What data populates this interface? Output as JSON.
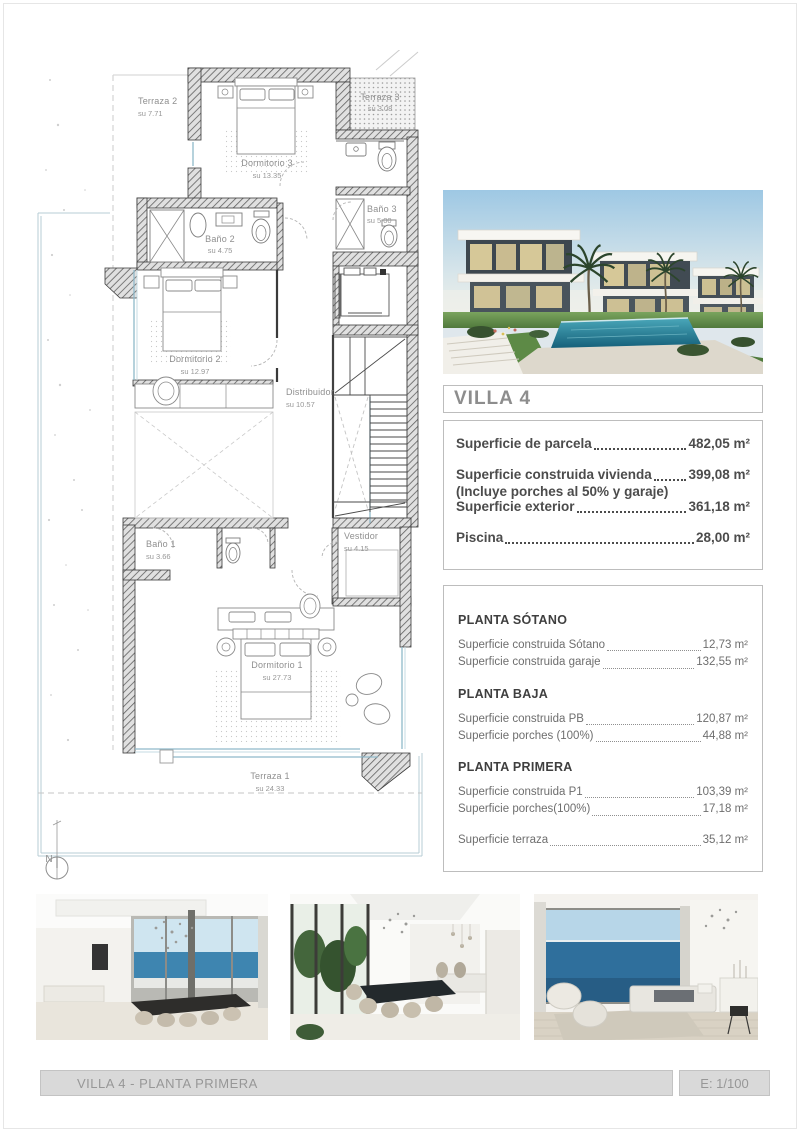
{
  "document": {
    "footer_title": "VILLA 4 - PLANTA PRIMERA",
    "footer_scale": "E: 1/100"
  },
  "info": {
    "title": "VILLA 4",
    "summary": [
      {
        "label": "Superficie de parcela",
        "value": "482,05 m²",
        "note": ""
      },
      {
        "label": "Superficie construida vivienda",
        "value": "399,08 m²",
        "note": "(Incluye porches al 50% y garaje)"
      },
      {
        "label": "Superficie exterior",
        "value": "361,18 m²",
        "note": ""
      },
      {
        "label": "Piscina",
        "value": "28,00 m²",
        "note": ""
      }
    ],
    "floors": [
      {
        "heading": "PLANTA SÓTANO",
        "rows": [
          {
            "label": "Superficie  construida Sótano",
            "value": "12,73 m²"
          },
          {
            "label": "Superficie construida garaje",
            "value": "132,55 m²"
          }
        ]
      },
      {
        "heading": "PLANTA BAJA",
        "rows": [
          {
            "label": "Superficie construida PB",
            "value": "120,87 m²"
          },
          {
            "label": "Superficie porches (100%)",
            "value": "44,88 m²"
          }
        ]
      },
      {
        "heading": "PLANTA PRIMERA",
        "rows": [
          {
            "label": "Superficie construida P1",
            "value": "103,39 m²"
          },
          {
            "label": "Superficie porches(100%)",
            "value": "17,18 m²"
          }
        ]
      }
    ],
    "extra_row": {
      "label": "Superficie terraza",
      "value": "35,12 m²"
    }
  },
  "plan": {
    "compass": "N",
    "rooms": [
      {
        "name": "Terraza 2",
        "area": "su 7.71"
      },
      {
        "name": "Dormitorio 3",
        "area": "su 13.35"
      },
      {
        "name": "Terraza 3",
        "area": "su 3.08"
      },
      {
        "name": "Baño 2",
        "area": "su 4.75"
      },
      {
        "name": "Baño 3",
        "area": "su 5.00"
      },
      {
        "name": "Dormitorio 2",
        "area": "su 12.97"
      },
      {
        "name": "Distribuidor",
        "area": "su 10.57"
      },
      {
        "name": "Baño 1",
        "area": "su 3.66"
      },
      {
        "name": "Vestidor",
        "area": "su 4.15"
      },
      {
        "name": "Dormitorio 1",
        "area": "su 27.73"
      },
      {
        "name": "Terraza 1",
        "area": "su 24.33"
      }
    ]
  },
  "colors": {
    "accent_blue": "#8fb9c9",
    "wall_dark": "#3a3a3a",
    "label_gray": "#8f8f8f",
    "footer_bg": "#d9d9d9",
    "title_gray": "#8d8d8d"
  }
}
